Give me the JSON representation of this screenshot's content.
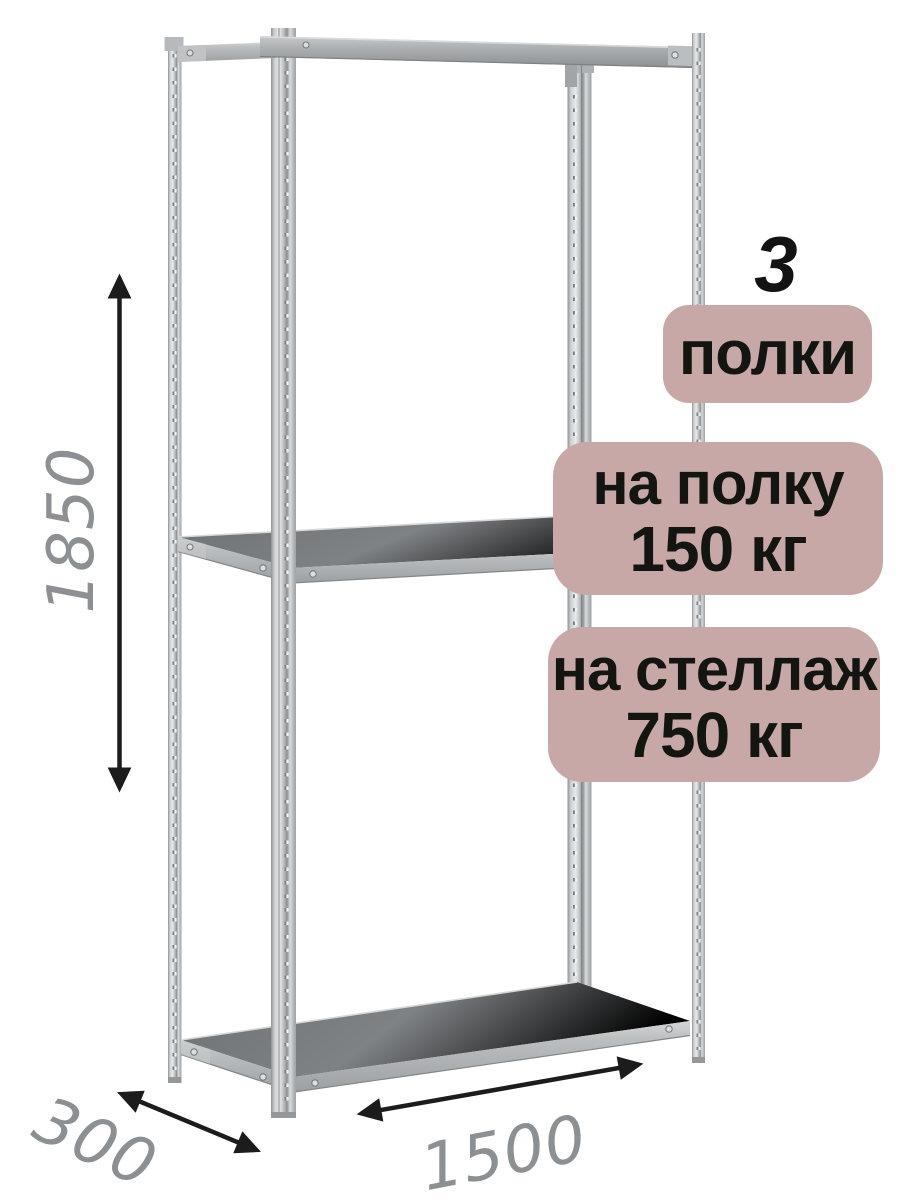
{
  "badges": {
    "count": {
      "value": "3",
      "label": "полки"
    },
    "per_shelf": {
      "line1": "на полку",
      "line2": "150 кг"
    },
    "per_rack": {
      "line1": "на стеллаж",
      "line2": "750 кг"
    }
  },
  "dimensions": {
    "height": "1850",
    "depth": "300",
    "width": "1500"
  },
  "colors": {
    "background": "#ffffff",
    "badge_bg": "#c7a8a6",
    "badge_text": "#121510",
    "dimension_text": "#8d9092",
    "arrow": "#1c1c1c",
    "metal_light": "#e8eaea",
    "metal_mid": "#b5b8ba",
    "metal_dark": "#8c8f92",
    "shelf_top": "#7a7d80",
    "shelf_face": "#b6b9bb"
  }
}
